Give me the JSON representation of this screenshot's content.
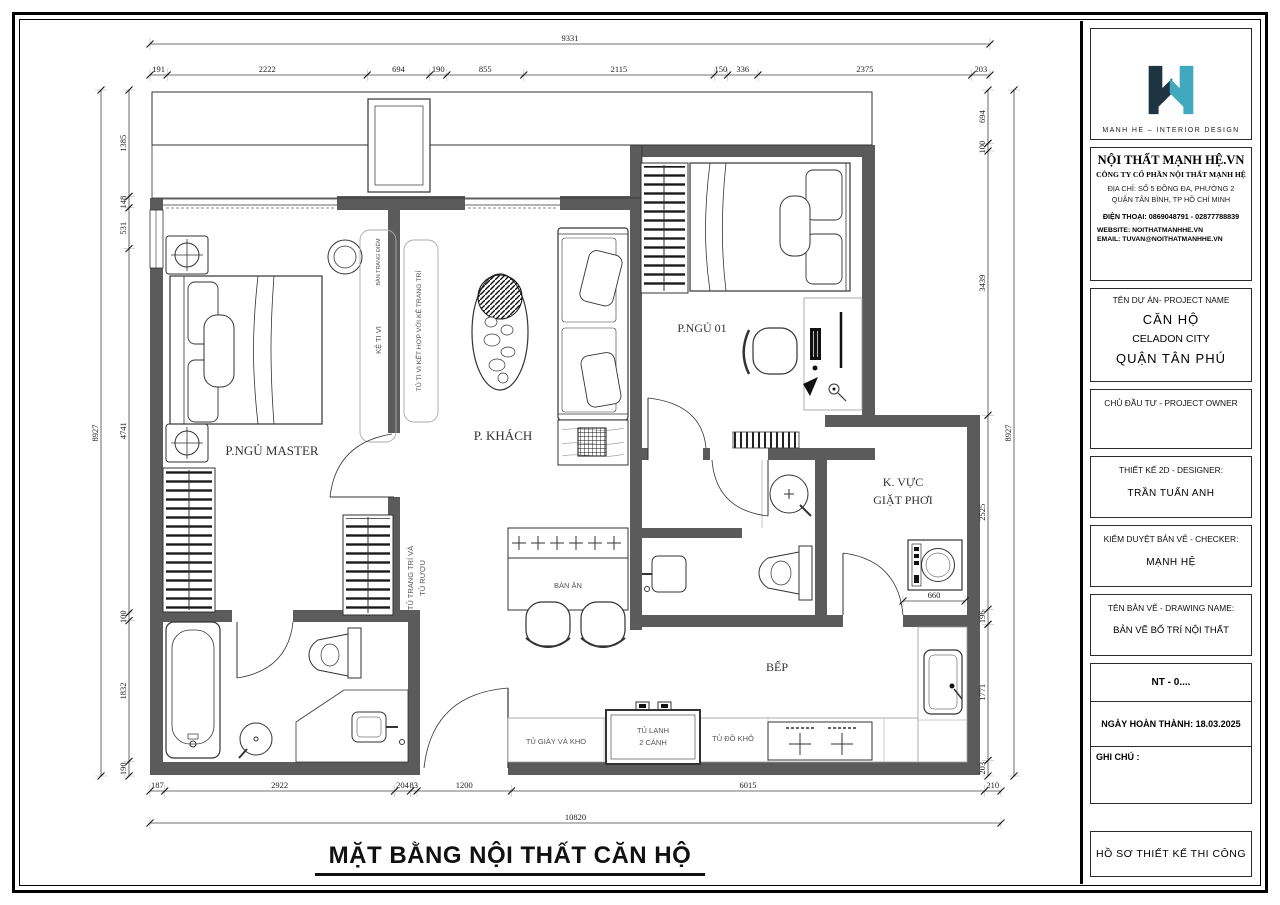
{
  "page": {
    "title": "MẶT BẰNG NỘI THẤT CĂN HỘ"
  },
  "titleblock": {
    "brand": {
      "logo_caption": "MANH HE – INTERIOR DESIGN",
      "colors": {
        "navy": "#1e3442",
        "teal": "#41a9bd"
      }
    },
    "company": {
      "name": "NỘI THẤT MẠNH HỆ.VN",
      "legal": "CÔNG TY CỔ PHẦN NỘI THẤT MẠNH HỆ",
      "address1": "ĐỊA CHỈ: SỐ 5 ĐỒNG ĐA, PHƯỜNG 2",
      "address2": "QUẬN TÂN BÌNH, TP HỒ CHÍ MINH",
      "phone": "ĐIỆN THOẠI: 0869048791  -  02877788839",
      "website": "WEBSITE: NOITHATMANHHE.VN",
      "email": "EMAIL:  TUVAN@NOITHATMANHHE.VN"
    },
    "project": {
      "heading": "TÊN DỰ ÁN- PROJECT NAME",
      "line1": "CĂN HỘ",
      "line2": "CELADON CITY",
      "line3": "QUẬN TÂN PHÚ"
    },
    "owner_heading": "CHỦ ĐẦU TƯ - PROJECT OWNER",
    "designer": {
      "heading": "THIẾT KẾ 2D - DESIGNER:",
      "name": "TRẦN TUẤN ANH"
    },
    "checker": {
      "heading": "KIỂM DUYỆT BẢN VẼ - CHECKER:",
      "name": "MẠNH HỆ"
    },
    "drawing": {
      "heading": "TÊN BẢN VẼ - DRAWING NAME:",
      "name": "BẢN VẼ BỐ TRÍ NỘI THẤT"
    },
    "number": "NT - 0....",
    "completion": "NGÀY HOÀN THÀNH: 18.03.2025",
    "notes_heading": "GHI CHÚ :",
    "footer": "HỒ SƠ THIẾT KẾ THI CÔNG"
  },
  "plan": {
    "wall_color": "#5b5b5b",
    "labels": [
      {
        "text": "P.NGỦ MASTER"
      },
      {
        "text": "P. KHÁCH"
      },
      {
        "text": "P.NGỦ 01"
      },
      {
        "text": "K. VỰC"
      },
      {
        "text": "GIẶT PHƠI"
      },
      {
        "text": "BẾP"
      },
      {
        "text": "BÀN ĂN"
      },
      {
        "text": "TỦ LẠNH"
      },
      {
        "text": "2 CÁNH"
      },
      {
        "text": "TỦ ĐỒ KHÔ"
      },
      {
        "text": "TỦ GIÀY VÀ KHO"
      },
      {
        "text": "KỆ TI VI"
      },
      {
        "text": "TỦ TI VI KẾT HỢP VỚI KỆ TRANG TRÍ"
      },
      {
        "text": "TỦ TRANG TRÍ  VÀ"
      },
      {
        "text": "TỦ RƯỢU"
      },
      {
        "text": "BÀN TRANG ĐIỂM"
      }
    ],
    "dimensions": {
      "top_overall": [
        9331
      ],
      "top": [
        191,
        2222,
        694,
        190,
        855,
        2115,
        150,
        336,
        2375,
        203
      ],
      "left": [
        1385,
        148,
        531,
        4741,
        100,
        1832,
        190
      ],
      "left_overall": [
        8927
      ],
      "right": [
        694,
        100,
        3439,
        2525,
        196,
        1771,
        203
      ],
      "right_overall": [
        8927
      ],
      "bottom": [
        187,
        2922,
        204,
        83,
        1200,
        6015,
        210
      ],
      "bottom_overall": [
        10820
      ],
      "laundry": [
        660
      ]
    }
  }
}
